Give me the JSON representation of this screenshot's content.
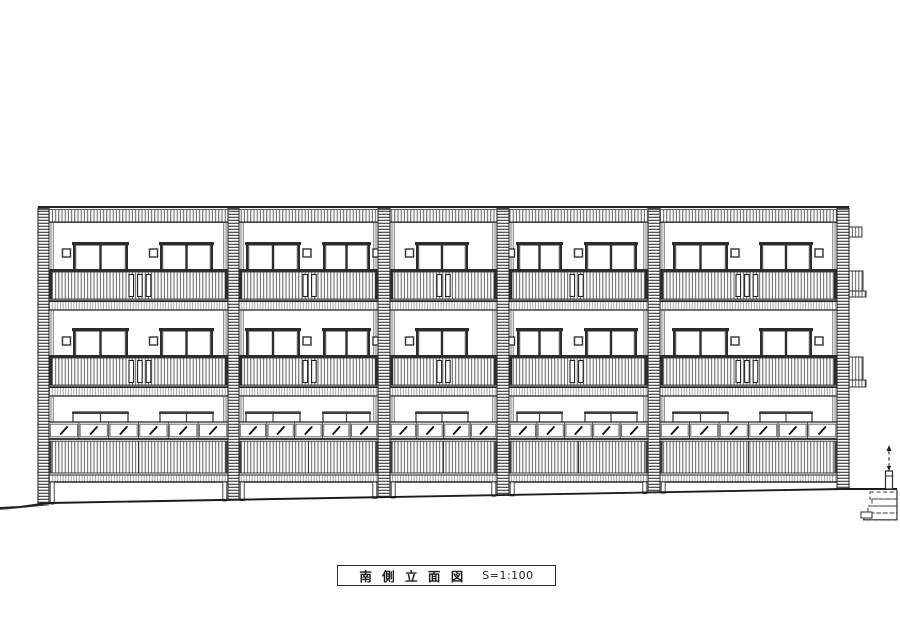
{
  "title_block": {
    "title": "南 側 立 面 図",
    "scale": "S=1:100"
  },
  "colors": {
    "line": "#222222",
    "frame": "#2c2c2c",
    "hatch": "#4a4a4a",
    "hatch_fine": "#909090",
    "bg": "#ffffff"
  },
  "elevation": {
    "canvas": {
      "w": 900,
      "h": 636
    },
    "roof": {
      "left": 38,
      "right": 849,
      "top": 207
    },
    "parapet": {
      "band_top": 210,
      "band_bottom": 221.5
    },
    "columns": [
      {
        "x": 38,
        "w": 11,
        "ground": 503
      },
      {
        "x": 228,
        "w": 11,
        "ground": 500
      },
      {
        "x": 378,
        "w": 12,
        "ground": 497
      },
      {
        "x": 497,
        "w": 12,
        "ground": 495
      },
      {
        "x": 648,
        "w": 12,
        "ground": 492
      },
      {
        "x": 837,
        "w": 12,
        "ground": 489
      }
    ],
    "floors_upper": [
      {
        "wall_top": 222,
        "win_top": 242,
        "win_bottom": 272,
        "vent_y": 249,
        "bal_bar": 269,
        "bal_hatch_top": 272,
        "bal_hatch_bottom": 299,
        "slab_top": 301.5,
        "slab_bottom": 310
      },
      {
        "wall_top": 310,
        "win_top": 328,
        "win_bottom": 358,
        "vent_y": 337,
        "bal_bar": 355,
        "bal_hatch_top": 358,
        "bal_hatch_bottom": 385,
        "slab_top": 387.5,
        "slab_bottom": 396
      }
    ],
    "ground_floor": {
      "wall_top": 396,
      "outline_top": 412,
      "outline_bottom": 423,
      "row_top": 422,
      "row_bottom": 439,
      "fence_top": 440,
      "fence_bottom": 473,
      "slab_top": 474,
      "slab_bottom": 482
    },
    "bays": [
      {
        "x": 49,
        "r": 228,
        "windows": [
          [
            73,
            55
          ],
          [
            160,
            53
          ]
        ],
        "vent_side": "left",
        "slots": {
          "x": 129,
          "n": 3
        },
        "cells": 6
      },
      {
        "x": 239,
        "r": 378,
        "windows": [
          [
            246,
            54
          ],
          [
            323,
            47
          ]
        ],
        "vent_side": "right",
        "slots": {
          "x": 303,
          "n": 2
        },
        "cells": 5
      },
      {
        "x": 390,
        "r": 497,
        "windows": [
          [
            416,
            52
          ]
        ],
        "vent_side": "left",
        "slots": {
          "x": 437,
          "n": 2
        },
        "cells": 4
      },
      {
        "x": 509,
        "r": 648,
        "windows": [
          [
            517,
            45
          ],
          [
            585,
            52
          ]
        ],
        "vent_side": "left",
        "slots": {
          "x": 570,
          "n": 2
        },
        "cells": 5
      },
      {
        "x": 660,
        "r": 837,
        "windows": [
          [
            673,
            55
          ],
          [
            760,
            52
          ]
        ],
        "vent_side": "right",
        "slots": {
          "x": 736,
          "n": 3
        },
        "cells": 6
      }
    ],
    "right_attachments": {
      "top_bar": {
        "x": 849,
        "y": 227,
        "w": 13,
        "h": 10
      },
      "balcony_walls": [
        {
          "x": 849,
          "y": 271,
          "w": 14,
          "h": 20,
          "lip_h": 6,
          "lip_extra": 3
        },
        {
          "x": 849,
          "y": 357,
          "w": 14,
          "h": 23,
          "lip_h": 7,
          "lip_extra": 3
        }
      ]
    },
    "ground_line": [
      [
        0,
        508
      ],
      [
        20,
        507
      ],
      [
        49,
        503
      ],
      [
        843,
        489
      ],
      [
        897,
        489
      ]
    ],
    "marker_pole": {
      "x": 889,
      "arrow_top": 445,
      "dash_bottom": 471,
      "base_top": 471,
      "base_bottom": 489,
      "base_w": 7
    },
    "buried_steps": [
      [
        870,
        492,
        27,
        7
      ],
      [
        872,
        499,
        25,
        7
      ],
      [
        868,
        506,
        29,
        7
      ],
      [
        864,
        513,
        33,
        7
      ]
    ]
  }
}
